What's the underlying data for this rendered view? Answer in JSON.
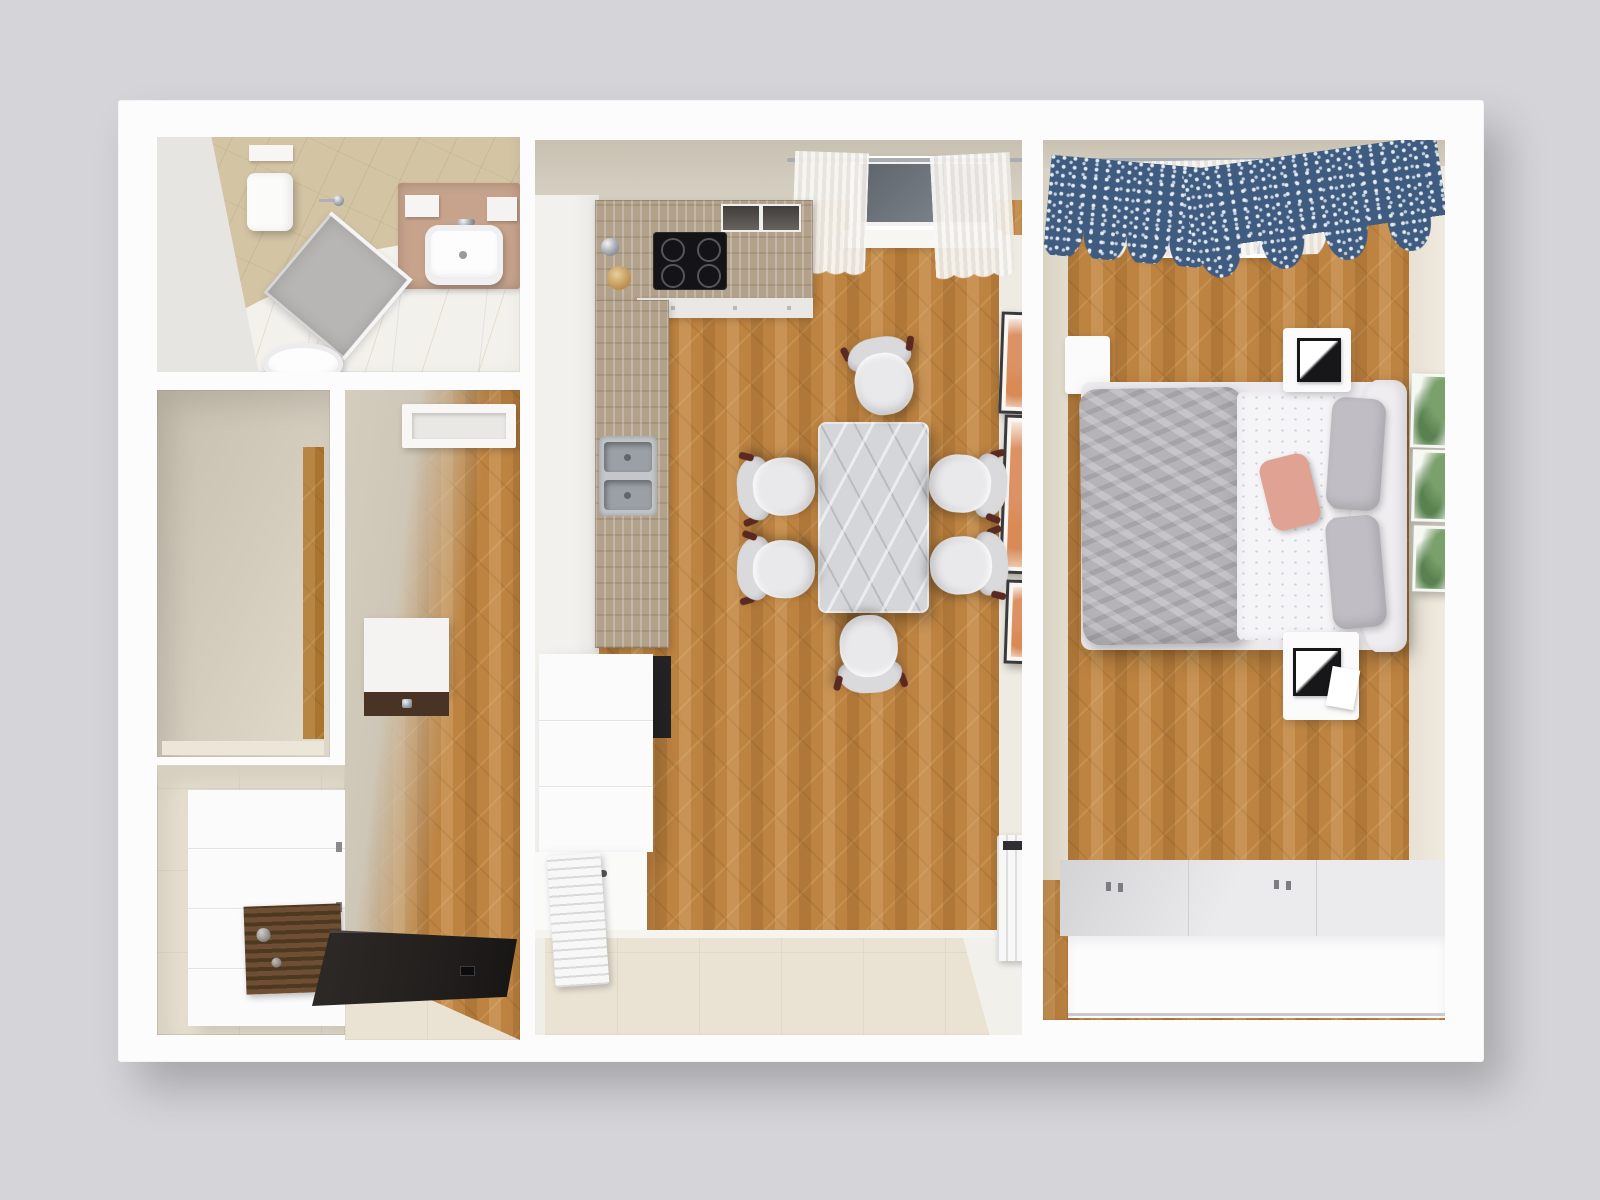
{
  "meta": {
    "title": "Apartment top-down 3D floor plan render",
    "view": "top-down perspective",
    "visible_text": "none"
  },
  "palette": {
    "background": "#d5d5d9",
    "wall": "#fcfcfd",
    "concrete": "#c8c1b2",
    "wall_face_beige": "#d4ccbd",
    "wall_face_tan": "#d3c4a4",
    "wood": "#bd8341",
    "wood_dark": "#a9742f",
    "tile": "#eae3d3",
    "marble_floor": "#f3f1ec",
    "travertine": "#b2a18b",
    "vanity": "#c7a38c",
    "steel": "#c3c6ca",
    "cooktop": "#141416",
    "glass_dark": "#5f646b",
    "table_marble": "#d5d6d9",
    "chair_seat": "#e9e9eb",
    "chair_back": "#dadadd",
    "chair_frame": "#5a2a22",
    "duvet": "#b5b3b7",
    "sheet": "#f5f4f7",
    "pillow_gray": "#c0bec4",
    "pillow_pink": "#e0a292",
    "headboard": "#efedf0",
    "curtain_blue": "#3f5c80",
    "curtain_sheer": "#f3f0ea",
    "mat_slats": "#6e4f33",
    "door_dark": "#23201e",
    "radiator": "#f7f7f8",
    "art_orange": "#dd9266",
    "art_green": "#7aa06b",
    "oven_dark": "#242426",
    "wardrobe_top": "#ebeaec"
  },
  "rooms": {
    "bathroom": {
      "label": "Bathroom",
      "items": [
        "water heater",
        "corner shower",
        "toilet",
        "washbasin on vanity",
        "marble floor"
      ]
    },
    "closet": {
      "label": "Storage room",
      "items": []
    },
    "hallway": {
      "label": "Hallway",
      "items": [
        "door frame",
        "wall console"
      ]
    },
    "entrance": {
      "label": "Entrance hall",
      "items": [
        "wardrobe cabinet",
        "slatted bench",
        "front door"
      ]
    },
    "kitchen": {
      "label": "Kitchen / dining",
      "items": [
        "L-shaped counter",
        "cooktop",
        "double sink",
        "oven column",
        "window with sheer curtains",
        "marble dining table",
        "six chairs",
        "three orange artworks",
        "two radiators",
        "tiled balcony strip"
      ]
    },
    "bedroom": {
      "label": "Bedroom",
      "items": [
        "double bed",
        "gray duvet",
        "pink pillow",
        "two nightstands with lamps",
        "dresser",
        "window with blue patterned curtains",
        "three green artworks",
        "built-in wardrobe"
      ]
    }
  }
}
